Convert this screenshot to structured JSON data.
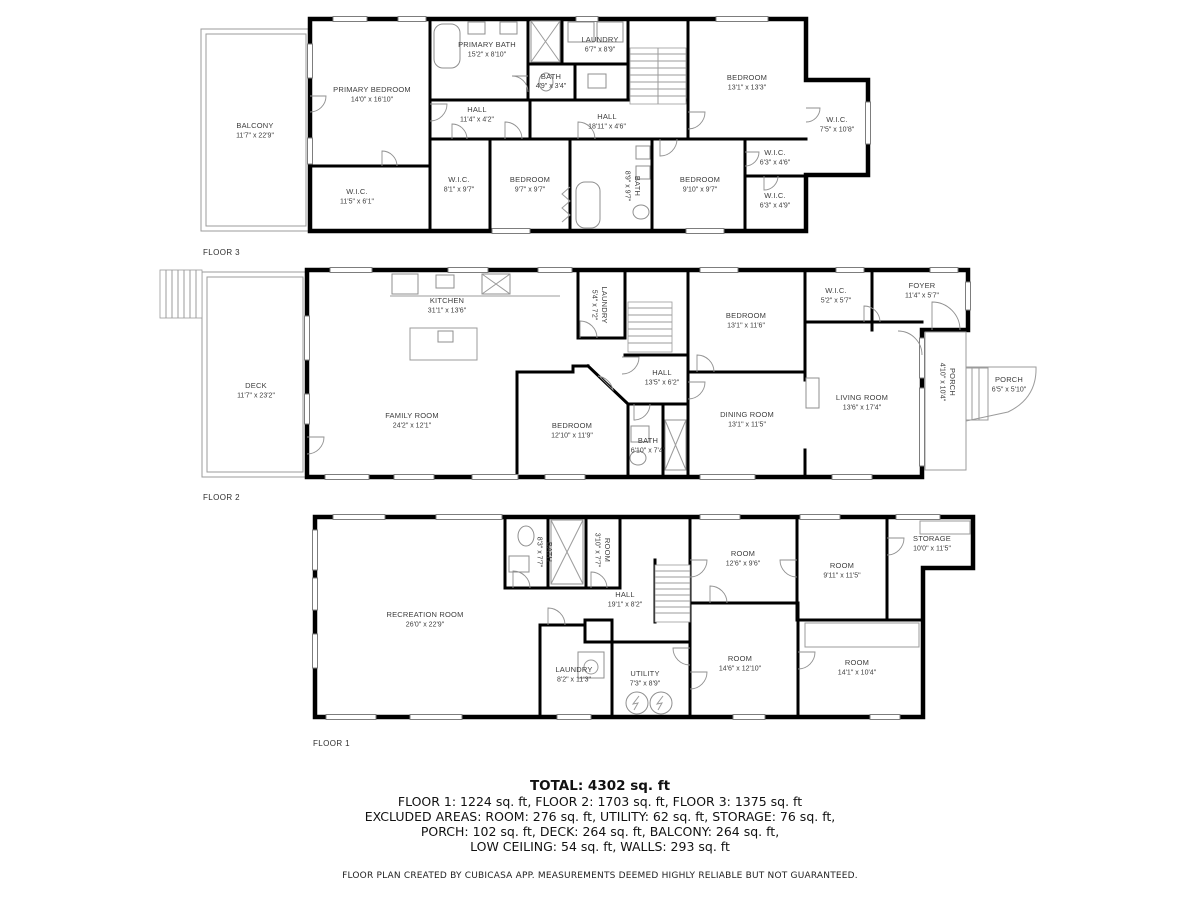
{
  "colors": {
    "wall": "#000000",
    "fixture": "#8f8f8f",
    "label": "#3d3d3d"
  },
  "floors": [
    {
      "label": "FLOOR 3",
      "rooms": [
        {
          "name": "BALCONY",
          "dims": "11'7\" x 22'9\""
        },
        {
          "name": "PRIMARY BEDROOM",
          "dims": "14'0\" x 16'10\""
        },
        {
          "name": "PRIMARY BATH",
          "dims": "15'2\" x 8'10\""
        },
        {
          "name": "BATH",
          "dims": "4'9\" x 3'4\""
        },
        {
          "name": "LAUNDRY",
          "dims": "6'7\" x 8'9\""
        },
        {
          "name": "HALL",
          "dims": "11'4\" x 4'2\""
        },
        {
          "name": "HALL",
          "dims": "18'11\" x 4'6\""
        },
        {
          "name": "W.I.C.",
          "dims": "11'5\" x 6'1\""
        },
        {
          "name": "W.I.C.",
          "dims": "8'1\" x 9'7\""
        },
        {
          "name": "BEDROOM",
          "dims": "9'7\" x 9'7\""
        },
        {
          "name": "BATH",
          "dims": "8'9\" x 9'7\""
        },
        {
          "name": "BEDROOM",
          "dims": "9'10\" x 9'7\""
        },
        {
          "name": "BEDROOM",
          "dims": "13'1\" x 13'3\""
        },
        {
          "name": "W.I.C.",
          "dims": "7'5\" x 10'8\""
        },
        {
          "name": "W.I.C.",
          "dims": "6'3\" x 4'6\""
        },
        {
          "name": "W.I.C.",
          "dims": "6'3\" x 4'9\""
        }
      ]
    },
    {
      "label": "FLOOR 2",
      "rooms": [
        {
          "name": "DECK",
          "dims": "11'7\" x 23'2\""
        },
        {
          "name": "KITCHEN",
          "dims": "31'1\" x 13'6\""
        },
        {
          "name": "FAMILY ROOM",
          "dims": "24'2\" x 12'1\""
        },
        {
          "name": "LAUNDRY",
          "dims": "5'4\" x 7'2\""
        },
        {
          "name": "BEDROOM",
          "dims": "13'1\" x 11'6\""
        },
        {
          "name": "W.I.C.",
          "dims": "5'2\" x 5'7\""
        },
        {
          "name": "FOYER",
          "dims": "11'4\" x 5'7\""
        },
        {
          "name": "HALL",
          "dims": "13'5\" x 6'2\""
        },
        {
          "name": "BEDROOM",
          "dims": "12'10\" x 11'9\""
        },
        {
          "name": "BATH",
          "dims": "6'10\" x 7'4\""
        },
        {
          "name": "DINING ROOM",
          "dims": "13'1\" x 11'5\""
        },
        {
          "name": "LIVING ROOM",
          "dims": "13'6\" x 17'4\""
        },
        {
          "name": "PORCH",
          "dims": "4'10\" x 10'4\""
        },
        {
          "name": "PORCH",
          "dims": "6'5\" x 5'10\""
        }
      ]
    },
    {
      "label": "FLOOR 1",
      "rooms": [
        {
          "name": "RECREATION ROOM",
          "dims": "26'0\" x 22'9\""
        },
        {
          "name": "BATH",
          "dims": "8'3\" x 7'7\""
        },
        {
          "name": "ROOM",
          "dims": "3'10\" x 7'7\""
        },
        {
          "name": "HALL",
          "dims": "19'1\" x 8'2\""
        },
        {
          "name": "LAUNDRY",
          "dims": "8'2\" x 11'3\""
        },
        {
          "name": "UTILITY",
          "dims": "7'3\" x 8'9\""
        },
        {
          "name": "ROOM",
          "dims": "12'6\" x 9'6\""
        },
        {
          "name": "ROOM",
          "dims": "9'11\" x 11'5\""
        },
        {
          "name": "STORAGE",
          "dims": "10'0\" x 11'5\""
        },
        {
          "name": "ROOM",
          "dims": "14'6\" x 12'10\""
        },
        {
          "name": "ROOM",
          "dims": "14'1\" x 10'4\""
        }
      ]
    }
  ],
  "summary": {
    "total": "TOTAL: 4302 sq. ft",
    "line1": "FLOOR 1: 1224 sq. ft, FLOOR 2: 1703 sq. ft, FLOOR 3: 1375 sq. ft",
    "line2": "EXCLUDED AREAS: ROOM: 276 sq. ft, UTILITY: 62 sq. ft, STORAGE: 76 sq. ft,",
    "line3": "PORCH: 102 sq. ft, DECK: 264 sq. ft, BALCONY: 264 sq. ft,",
    "line4": "LOW CEILING: 54 sq. ft, WALLS: 293 sq. ft"
  },
  "disclaimer": "FLOOR PLAN CREATED BY CUBICASA APP. MEASUREMENTS DEEMED HIGHLY RELIABLE BUT NOT GUARANTEED."
}
